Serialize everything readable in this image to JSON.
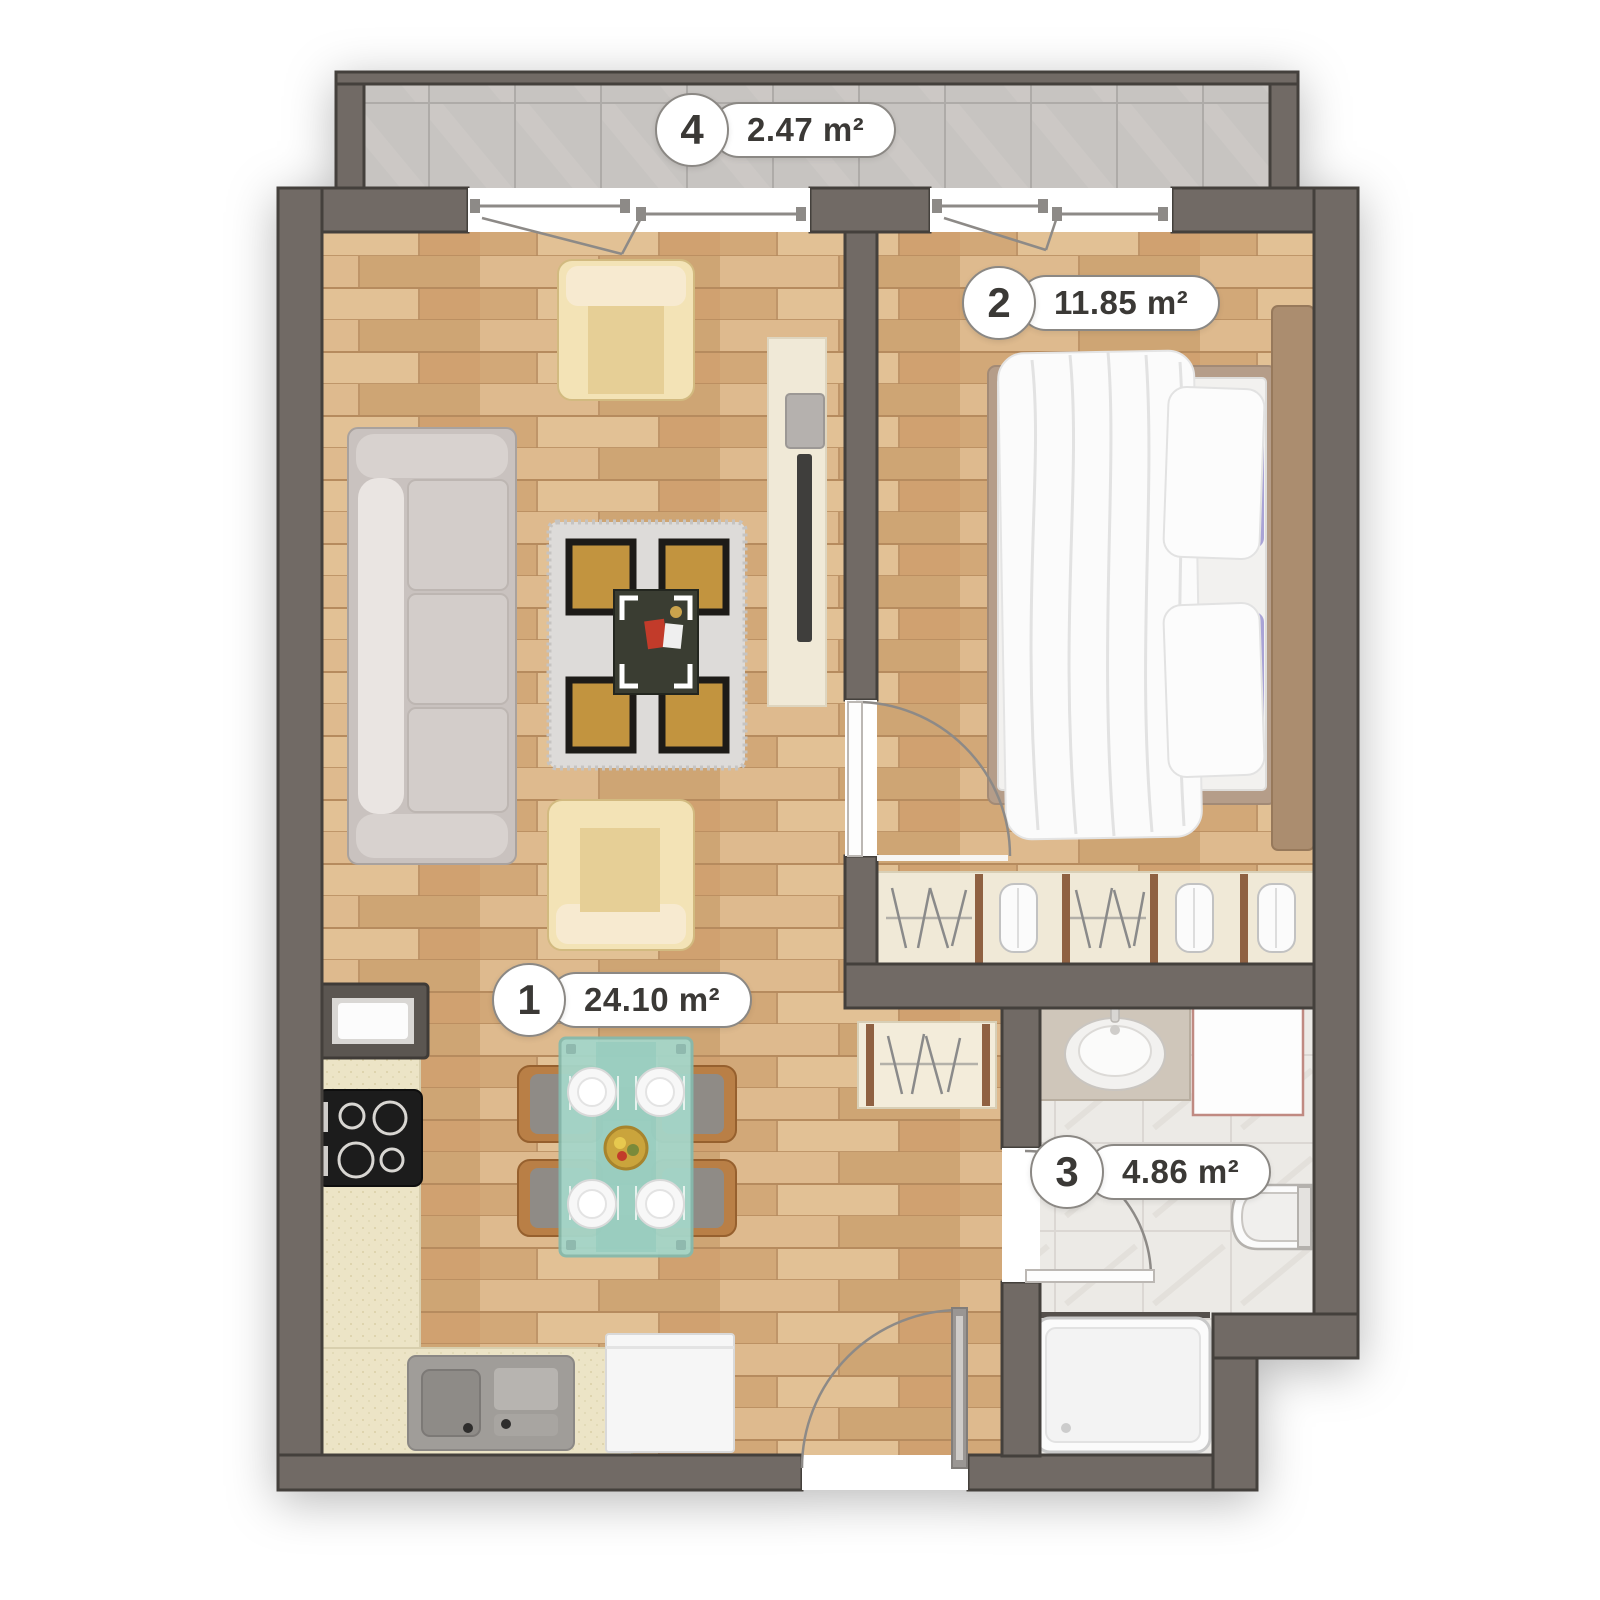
{
  "title": "Apartment floor plan",
  "rooms": [
    {
      "number": "1",
      "area": "24.10 m²",
      "name": "living-room-kitchen"
    },
    {
      "number": "2",
      "area": "11.85 m²",
      "name": "bedroom"
    },
    {
      "number": "3",
      "area": "4.86 m²",
      "name": "bathroom"
    },
    {
      "number": "4",
      "area": "2.47 m²",
      "name": "balcony"
    }
  ],
  "colors": {
    "wall": "#716a65",
    "wall-line": "#44403c",
    "wood": "#d6b083",
    "balcony-tile": "#c7c4c1",
    "bath-tile": "#eceae6",
    "counter": "#ece4c6",
    "cream": "#f0e9d7",
    "sofa": "#c9c2bf",
    "armchair": "#f3e3b6",
    "rug-gold": "#c2943f",
    "table": "#a5d6c9",
    "chair-wood": "#b97f46",
    "bed-frame": "#b59d89",
    "pillow": "#a9a3d6",
    "arc": "#8d8a87",
    "label-border": "#8b8884",
    "label-text": "#3b3936"
  }
}
